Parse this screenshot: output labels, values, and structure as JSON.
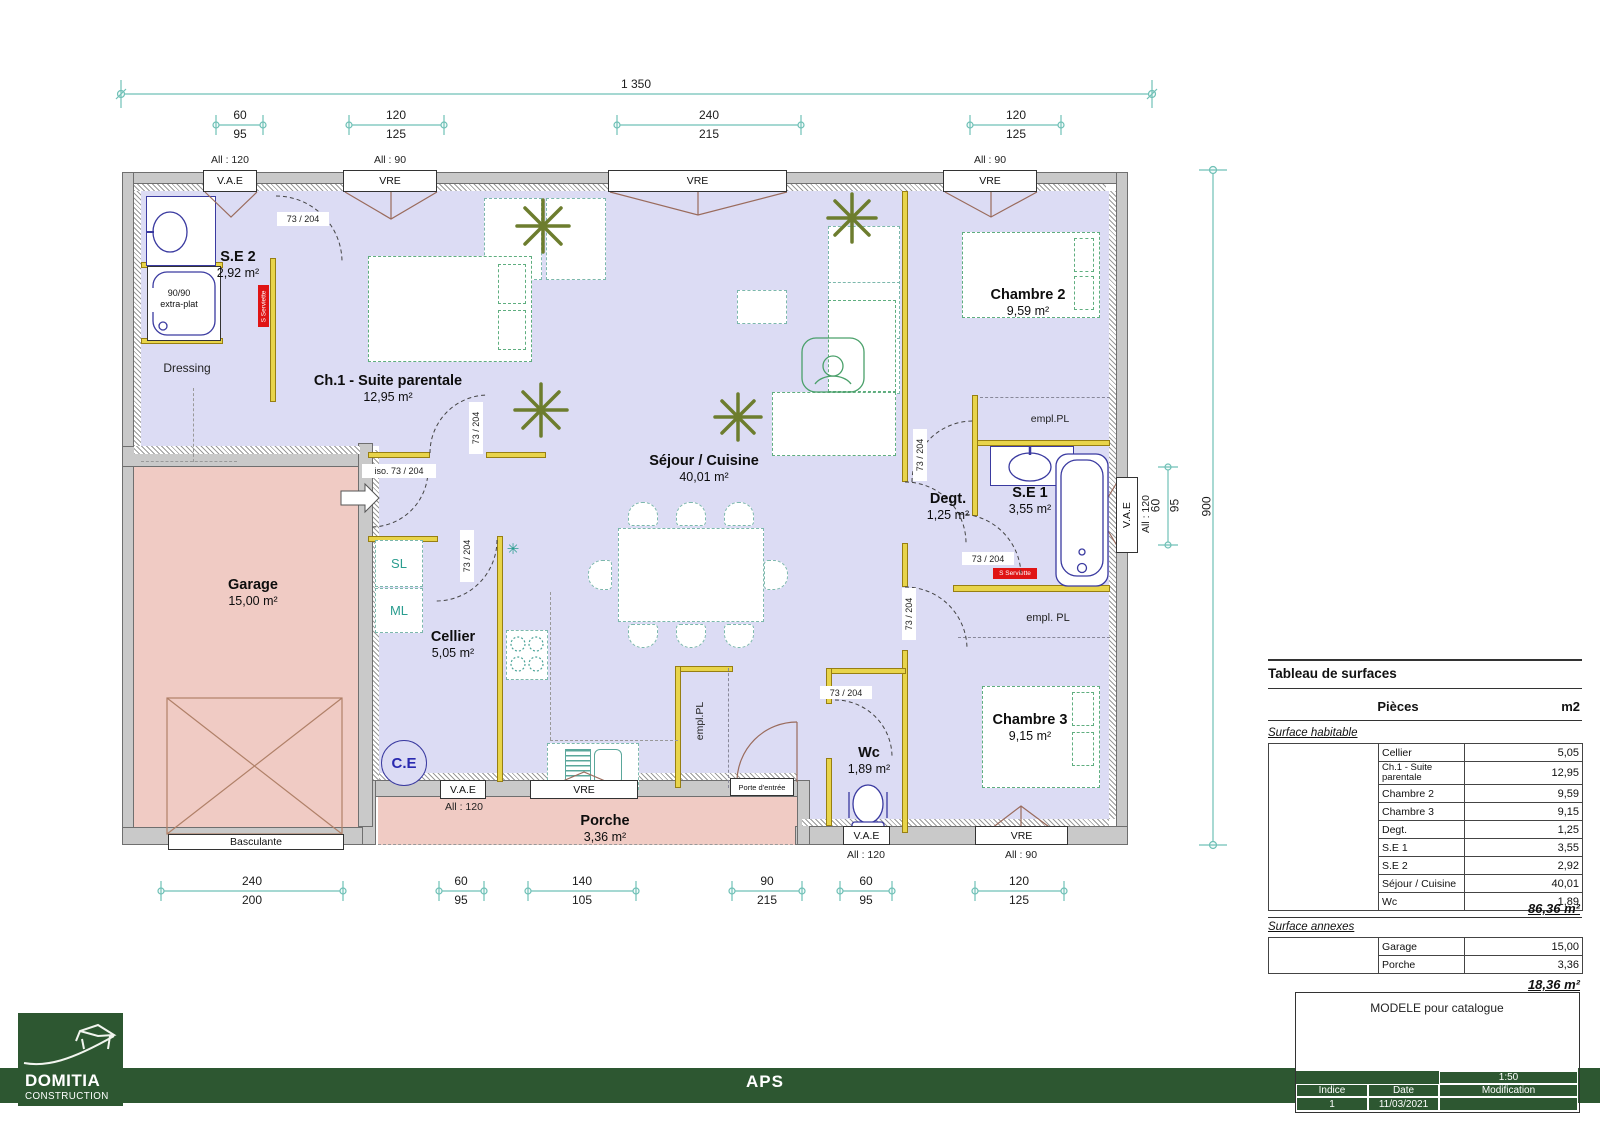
{
  "colors": {
    "brand_green": "#2d5731",
    "wall": "#c9c9c9",
    "floor": "#dcdcf4",
    "annex": "#f0cbc4",
    "partition": "#e8d44a",
    "dimension": "#6fc0b6",
    "fixture_blue": "#3a3aa0",
    "furniture_green": "#5fae7f",
    "label_red": "#e01414"
  },
  "plan": {
    "rooms": {
      "se2": {
        "name": "S.E 2",
        "area": "2,92 m²"
      },
      "ch1": {
        "name": "Ch.1 - Suite parentale",
        "area": "12,95 m²"
      },
      "dressing": {
        "name": "Dressing"
      },
      "sejour": {
        "name": "Séjour / Cuisine",
        "area": "40,01 m²"
      },
      "cellier": {
        "name": "Cellier",
        "area": "5,05 m²"
      },
      "garage": {
        "name": "Garage",
        "area": "15,00 m²"
      },
      "degt": {
        "name": "Degt.",
        "area": "1,25 m²"
      },
      "se1": {
        "name": "S.E 1",
        "area": "3,55 m²"
      },
      "chambre2": {
        "name": "Chambre 2",
        "area": "9,59 m²"
      },
      "chambre3": {
        "name": "Chambre 3",
        "area": "9,15 m²"
      },
      "wc": {
        "name": "Wc",
        "area": "1,89 m²"
      },
      "porche": {
        "name": "Porche",
        "area": "3,36 m²"
      }
    },
    "fixtures": {
      "shower_line1": "90/90",
      "shower_line2": "extra-plat",
      "towel_dryer": "S Serviette",
      "water_heater": "C.E",
      "sl": "SL",
      "ml": "ML"
    },
    "doors": {
      "standard": "73 / 204",
      "insulated": "iso.  73 / 204",
      "entry": "Porte d'entrée",
      "garage": "Basculante"
    },
    "windows": {
      "vae": "V.A.E",
      "vre": "VRE",
      "sill_120": "All : 120",
      "sill_90": "All : 90"
    },
    "closet": {
      "pl": "empl.PL",
      "pl_spaced": "empl. PL"
    }
  },
  "dimensions": {
    "overall_width": "1 350",
    "overall_height": "900",
    "top": [
      {
        "a": "60",
        "b": "95"
      },
      {
        "a": "120",
        "b": "125"
      },
      {
        "a": "240",
        "b": "215"
      },
      {
        "a": "120",
        "b": "125"
      }
    ],
    "bottom": [
      {
        "a": "240",
        "b": "200"
      },
      {
        "a": "60",
        "b": "95"
      },
      {
        "a": "140",
        "b": "105"
      },
      {
        "a": "90",
        "b": "215"
      },
      {
        "a": "60",
        "b": "95"
      },
      {
        "a": "120",
        "b": "125"
      }
    ],
    "right": {
      "a": "60",
      "b": "95"
    }
  },
  "surface_table": {
    "title": "Tableau de surfaces",
    "col_pieces": "Pièces",
    "col_unit": "m2",
    "habitable_label": "Surface habitable",
    "habitable_rows": [
      {
        "label": "Cellier",
        "value": "5,05"
      },
      {
        "label": "Ch.1 - Suite parentale",
        "value": "12,95"
      },
      {
        "label": "Chambre 2",
        "value": "9,59"
      },
      {
        "label": "Chambre 3",
        "value": "9,15"
      },
      {
        "label": "Degt.",
        "value": "1,25"
      },
      {
        "label": "S.E 1",
        "value": "3,55"
      },
      {
        "label": "S.E 2",
        "value": "2,92"
      },
      {
        "label": "Séjour / Cuisine",
        "value": "40,01"
      },
      {
        "label": "Wc",
        "value": "1,89"
      }
    ],
    "habitable_total": "86,36 m²",
    "annexes_label": "Surface annexes",
    "annexes_rows": [
      {
        "label": "Garage",
        "value": "15,00"
      },
      {
        "label": "Porche",
        "value": "3,36"
      }
    ],
    "annexes_total": "18,36 m²"
  },
  "title_block": {
    "model": "MODELE pour catalogue",
    "scale": "1:50",
    "indice_label": "Indice",
    "date_label": "Date",
    "modification_label": "Modification",
    "indice": "1",
    "date": "11/03/2021",
    "modification": ""
  },
  "footer": {
    "doc_type": "APS",
    "company": "DOMITIA",
    "company_sub": "CONSTRUCTION"
  }
}
